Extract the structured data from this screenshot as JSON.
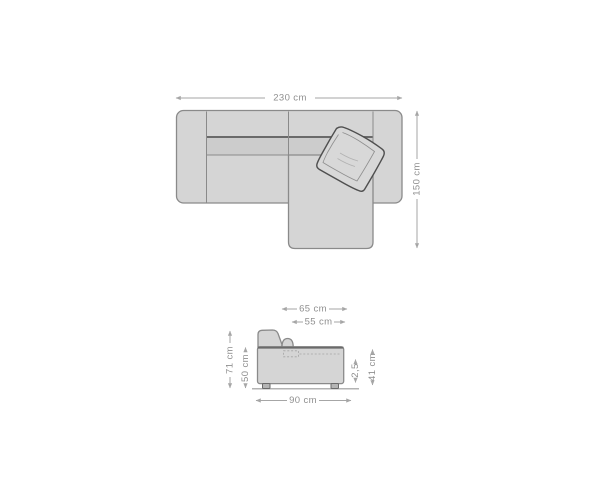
{
  "colors": {
    "background": "#ffffff",
    "sofa_fill": "#d5d5d5",
    "sofa_fill_dark": "#cccccc",
    "outline": "#8a8a8a",
    "outline_dark": "#6a6a6a",
    "pillow_fill": "#d8d8d8",
    "pillow_outline": "#4f4f4f",
    "flange_line": "#8f8f8f",
    "stitch_line": "#b2b2b2",
    "leg_fill": "#b5b5b5",
    "ground": "#9a9a9a",
    "dash_line": "#a5a5a5",
    "dim_line": "#a6a6a6",
    "dim_text": "#8f8f8f"
  },
  "top_view": {
    "width_label": "230 cm",
    "depth_label": "150 cm"
  },
  "side_view": {
    "backrest_depth_label": "65 cm",
    "seat_depth_label": "55 cm",
    "total_height_label": "71 cm",
    "body_height_label": "50 cm",
    "ground_clearance_label": "2,5",
    "seat_height_label": "41 cm",
    "total_depth_label": "90 cm"
  }
}
